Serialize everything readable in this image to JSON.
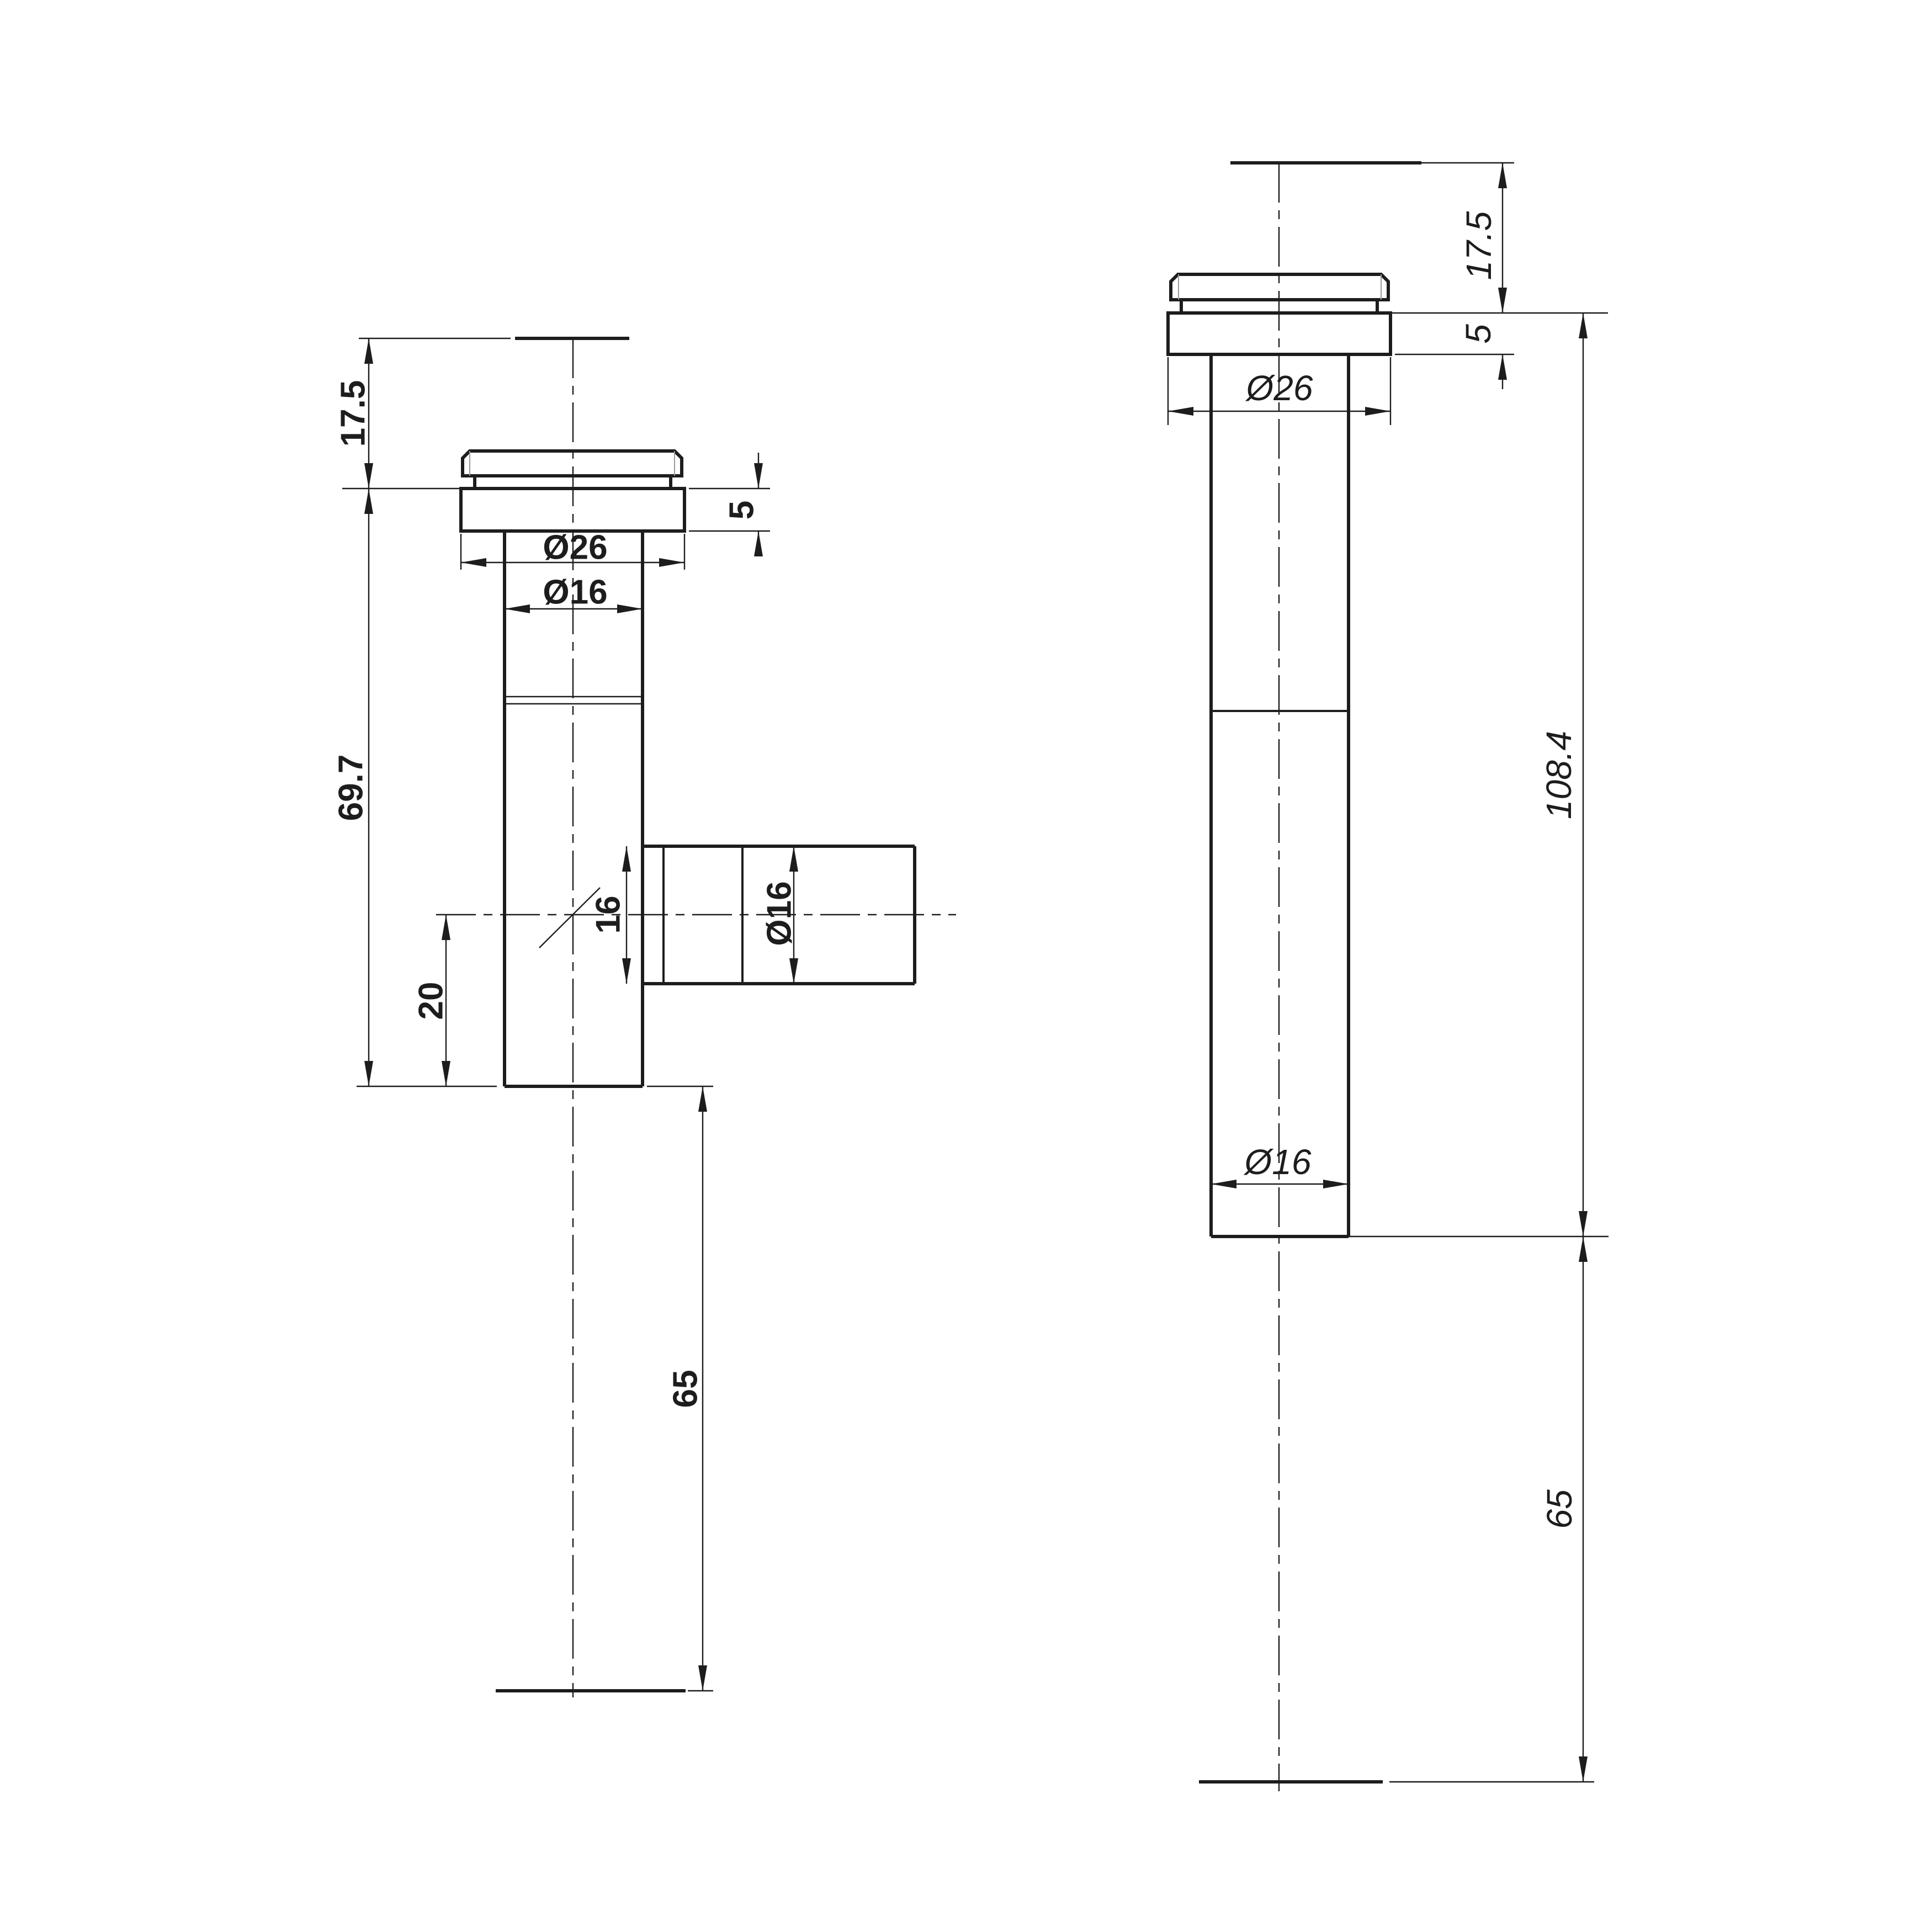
{
  "canvas": {
    "background": "#ffffff",
    "line_color": "#1d1d1d"
  },
  "left_view": {
    "dimensions": {
      "top_offset": "17.5",
      "body_length": "69.7",
      "flange_thickness": "5",
      "flange_diameter": "Ø26",
      "tube_diameter": "Ø16",
      "branch_bore": "16",
      "branch_diameter": "Ø16",
      "branch_center_offset": "20",
      "lower_length": "65"
    }
  },
  "right_view": {
    "dimensions": {
      "top_offset": "17.5",
      "flange_thickness": "5",
      "flange_diameter": "Ø26",
      "overall_length": "108.4",
      "tube_diameter": "Ø16",
      "lower_length": "65"
    }
  }
}
